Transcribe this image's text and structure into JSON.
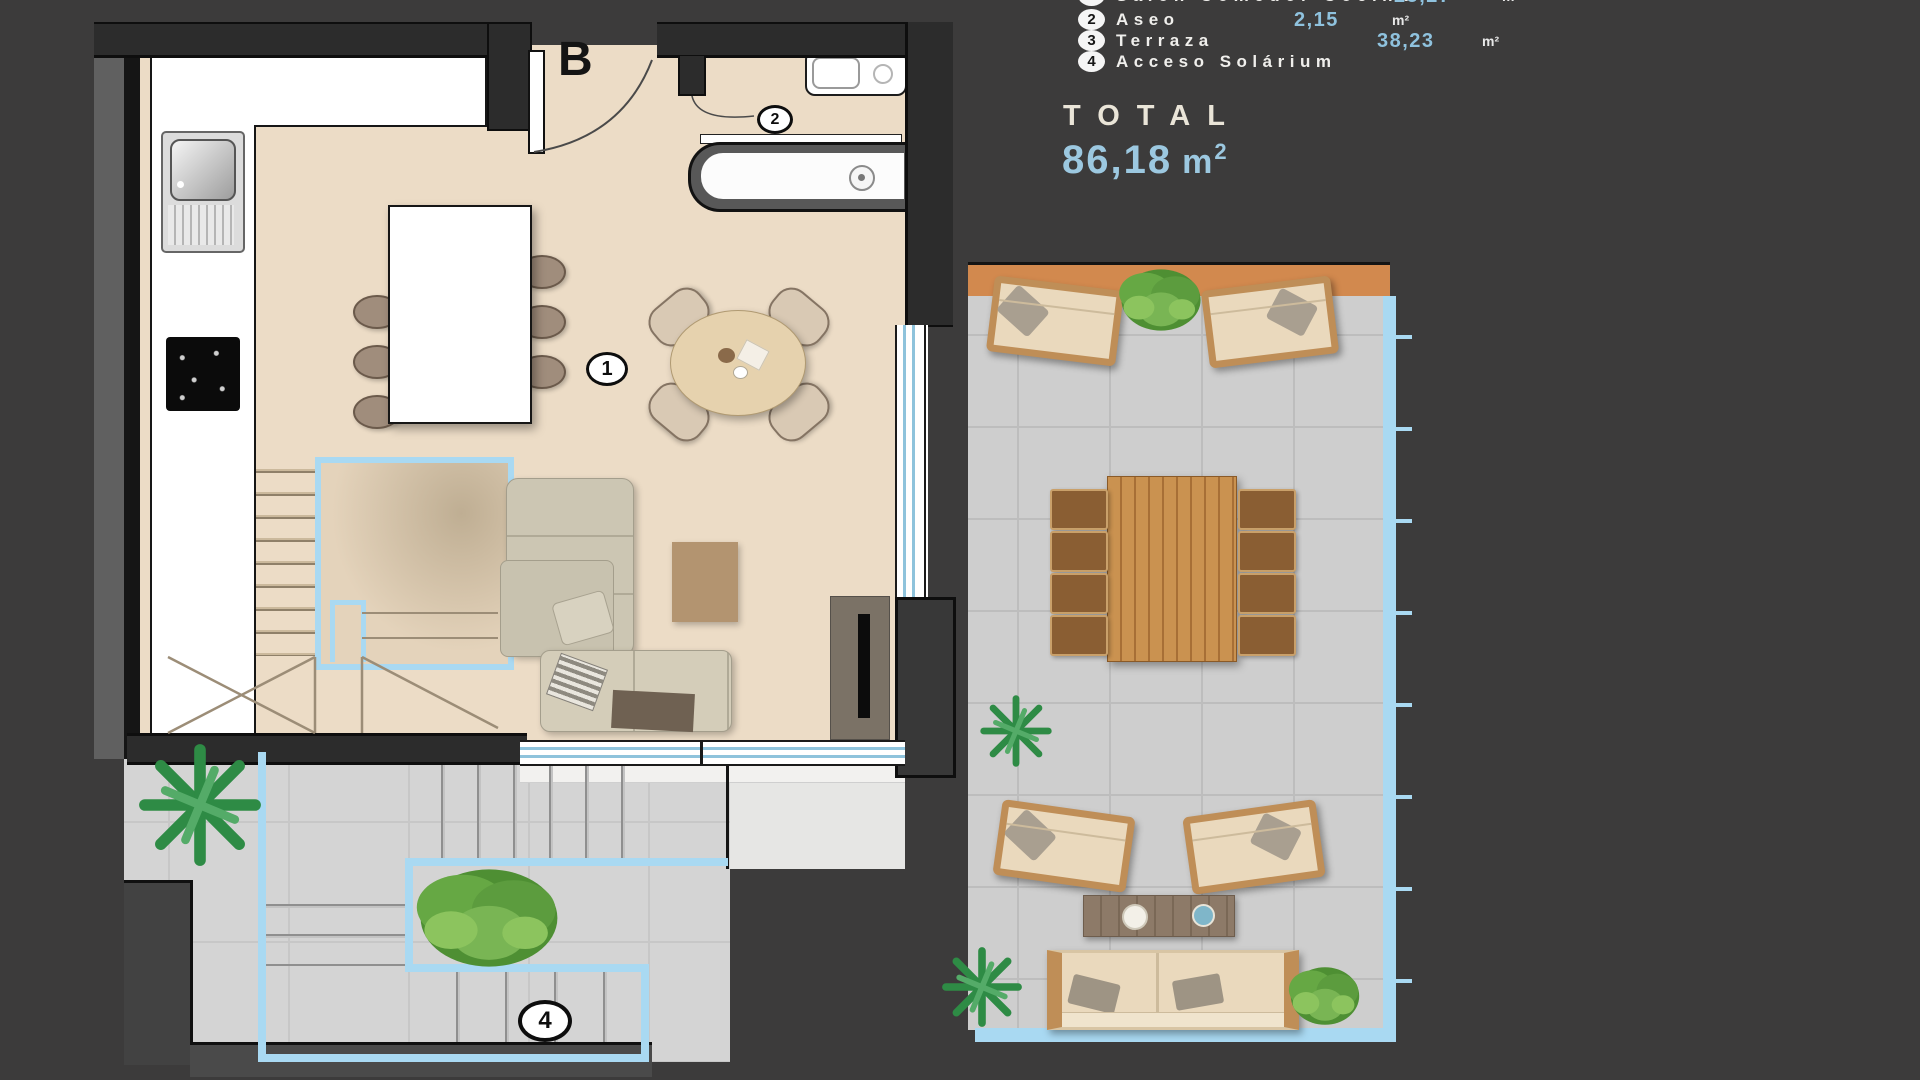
{
  "colors": {
    "background": "#3c3b3b",
    "accent_value_blue": "#8fc2de",
    "total_value_blue": "#9cc8e0",
    "plan_highlight_blue": "#a9d9f2",
    "floor_beige": "#ecdcc6",
    "terrace_tile_gray": "#cecece",
    "terrace_wood_strip": "#d2894e",
    "wall_dark": "#2c2c2c"
  },
  "legend": {
    "rows": [
      {
        "num": "1",
        "label": "Salón Comedor Cocina",
        "value": "25,27",
        "unit": "m²"
      },
      {
        "num": "2",
        "label": "Aseo",
        "value": "2,15",
        "unit": "m²"
      },
      {
        "num": "3",
        "label": "Terraza",
        "value": "38,23",
        "unit": "m²"
      },
      {
        "num": "4",
        "label": "Acceso Solárium",
        "value": "",
        "unit": ""
      }
    ],
    "total": {
      "label": "TOTAL",
      "value": "86,18",
      "unit_base": "m",
      "unit_sup": "2"
    }
  },
  "plan": {
    "door_label": "B",
    "badges": {
      "living": "1",
      "aseo": "2",
      "solarium": "4"
    }
  }
}
